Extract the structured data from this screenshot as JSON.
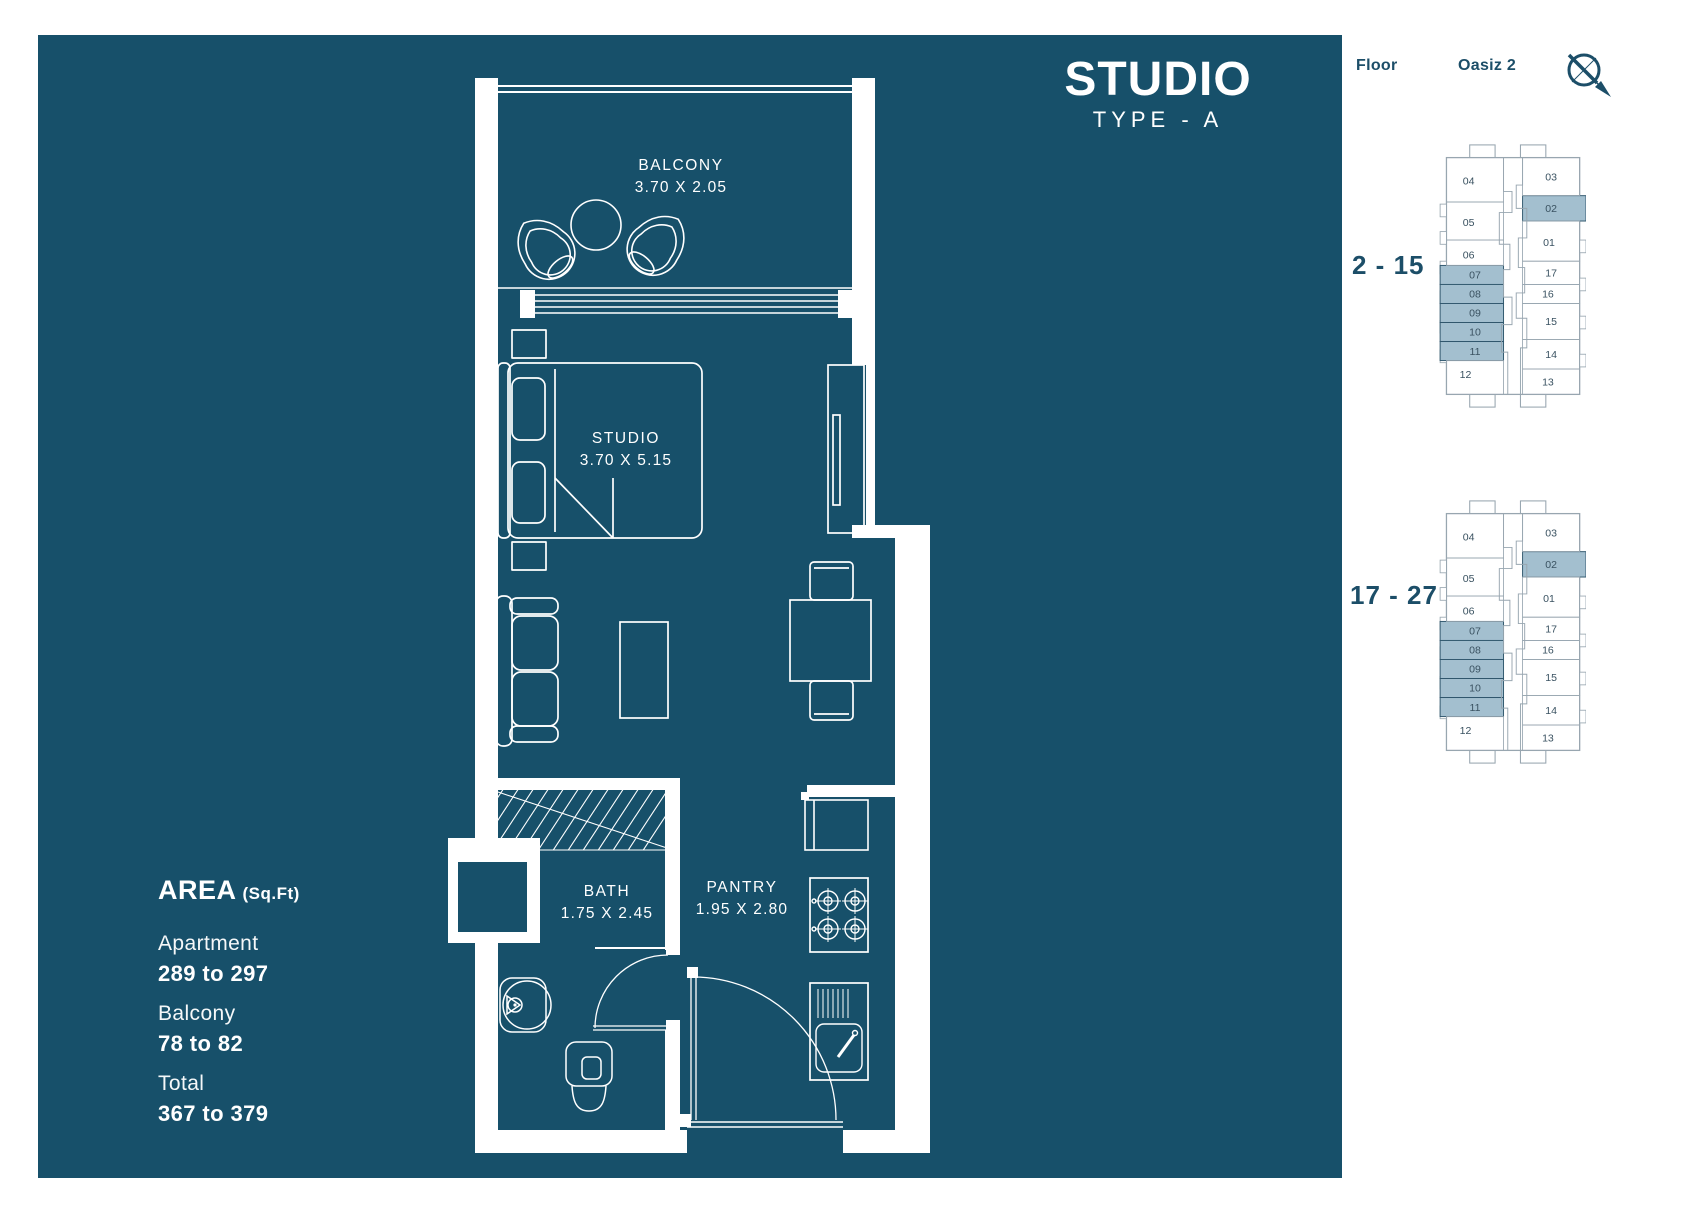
{
  "colors": {
    "background": "#17506A",
    "plan_line": "#FFFFFF",
    "side_text": "#1C4E68",
    "highlight": "#A3BFCF",
    "highlight_border": "#2F566C",
    "map_line": "#98A6B0",
    "unit_text": "#3A5261"
  },
  "title": {
    "main": "STUDIO",
    "sub": "TYPE - A"
  },
  "plan": {
    "balcony": {
      "name": "BALCONY",
      "dims": "3.70 X 2.05"
    },
    "studio": {
      "name": "STUDIO",
      "dims": "3.70 X 5.15"
    },
    "bath": {
      "name": "BATH",
      "dims": "1.75 X 2.45"
    },
    "pantry": {
      "name": "PANTRY",
      "dims": "1.95 X 2.80"
    }
  },
  "area": {
    "heading": "AREA",
    "unit_label": "(Sq.Ft)",
    "rows": [
      {
        "label": "Apartment",
        "value": "289 to 297"
      },
      {
        "label": "Balcony",
        "value": "78 to 82"
      },
      {
        "label": "Total",
        "value": "367 to 379"
      }
    ]
  },
  "floor_key": {
    "floor_label": "Floor",
    "building_label": "Oasiz 2",
    "maps": [
      {
        "floor_range": "2 - 15"
      },
      {
        "floor_range": "17 - 27"
      }
    ],
    "units": [
      {
        "id": "04",
        "highlighted": false
      },
      {
        "id": "05",
        "highlighted": false
      },
      {
        "id": "06",
        "highlighted": false
      },
      {
        "id": "07",
        "highlighted": true
      },
      {
        "id": "08",
        "highlighted": true
      },
      {
        "id": "09",
        "highlighted": true
      },
      {
        "id": "10",
        "highlighted": true
      },
      {
        "id": "11",
        "highlighted": true
      },
      {
        "id": "12",
        "highlighted": false
      },
      {
        "id": "03",
        "highlighted": false
      },
      {
        "id": "02",
        "highlighted": true
      },
      {
        "id": "01",
        "highlighted": false
      },
      {
        "id": "17",
        "highlighted": false
      },
      {
        "id": "16",
        "highlighted": false
      },
      {
        "id": "15",
        "highlighted": false
      },
      {
        "id": "14",
        "highlighted": false
      },
      {
        "id": "13",
        "highlighted": false
      }
    ]
  }
}
